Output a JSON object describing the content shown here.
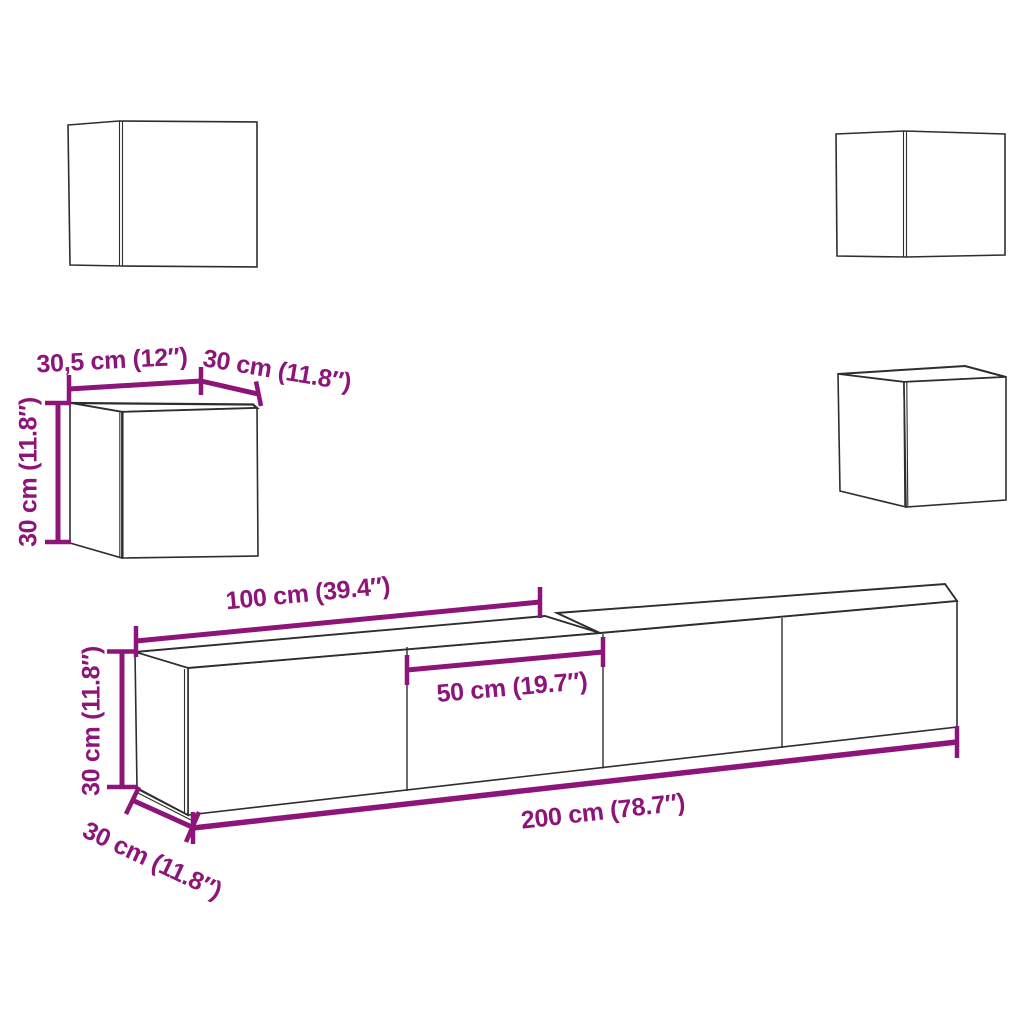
{
  "colors": {
    "background": "#ffffff",
    "dimension_accent": "#8d1478",
    "furniture_outline": "#2e2e2e"
  },
  "labels": {
    "cube_width": "30,5 cm (12″)",
    "cube_depth": "30 cm (11.8″)",
    "cube_height": "30 cm (11.8″)",
    "cabinet_section_width": "100 cm (39.4″)",
    "cabinet_door_width": "50 cm (19.7″)",
    "cabinet_total_width": "200 cm (78.7″)",
    "cabinet_height": "30 cm (11.8″)",
    "cabinet_depth": "30 cm (11.8″)"
  }
}
